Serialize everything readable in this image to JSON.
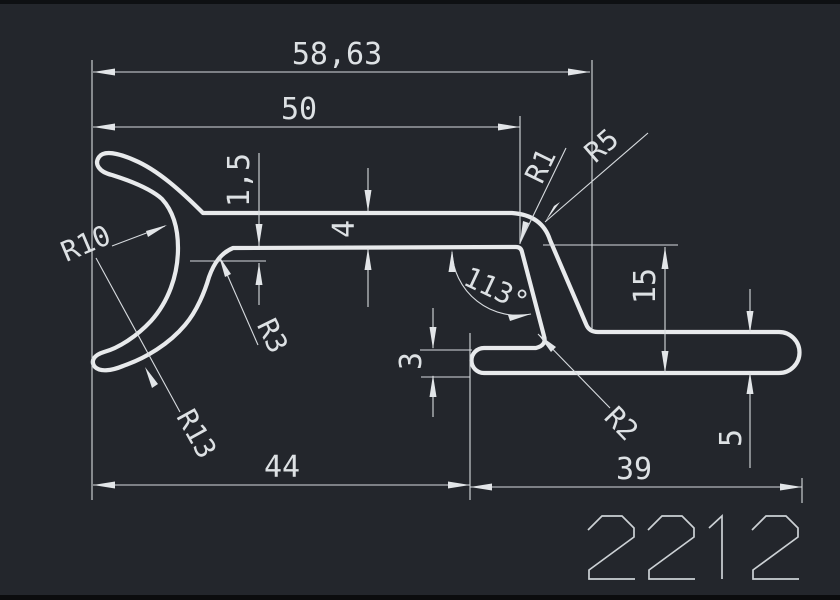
{
  "drawing": {
    "part_number": "2212",
    "background_color": "#23262c",
    "line_color": "#e8eaec",
    "dimensions": {
      "total_width": "58,63",
      "upper_width": "50",
      "left_width": "44",
      "foot_width": "39",
      "wall_bar": "4",
      "lip_offset": "1,5",
      "height_right": "15",
      "foot_left_thickness": "3",
      "foot_right_thickness": "5",
      "angle": "113°",
      "radius_hook_inner": "R10",
      "radius_hook_outer": "R13",
      "radius_hook_fillet": "R3",
      "radius_vertex": "R1",
      "radius_top_corner": "R5",
      "radius_foot_fillet": "R2"
    }
  }
}
